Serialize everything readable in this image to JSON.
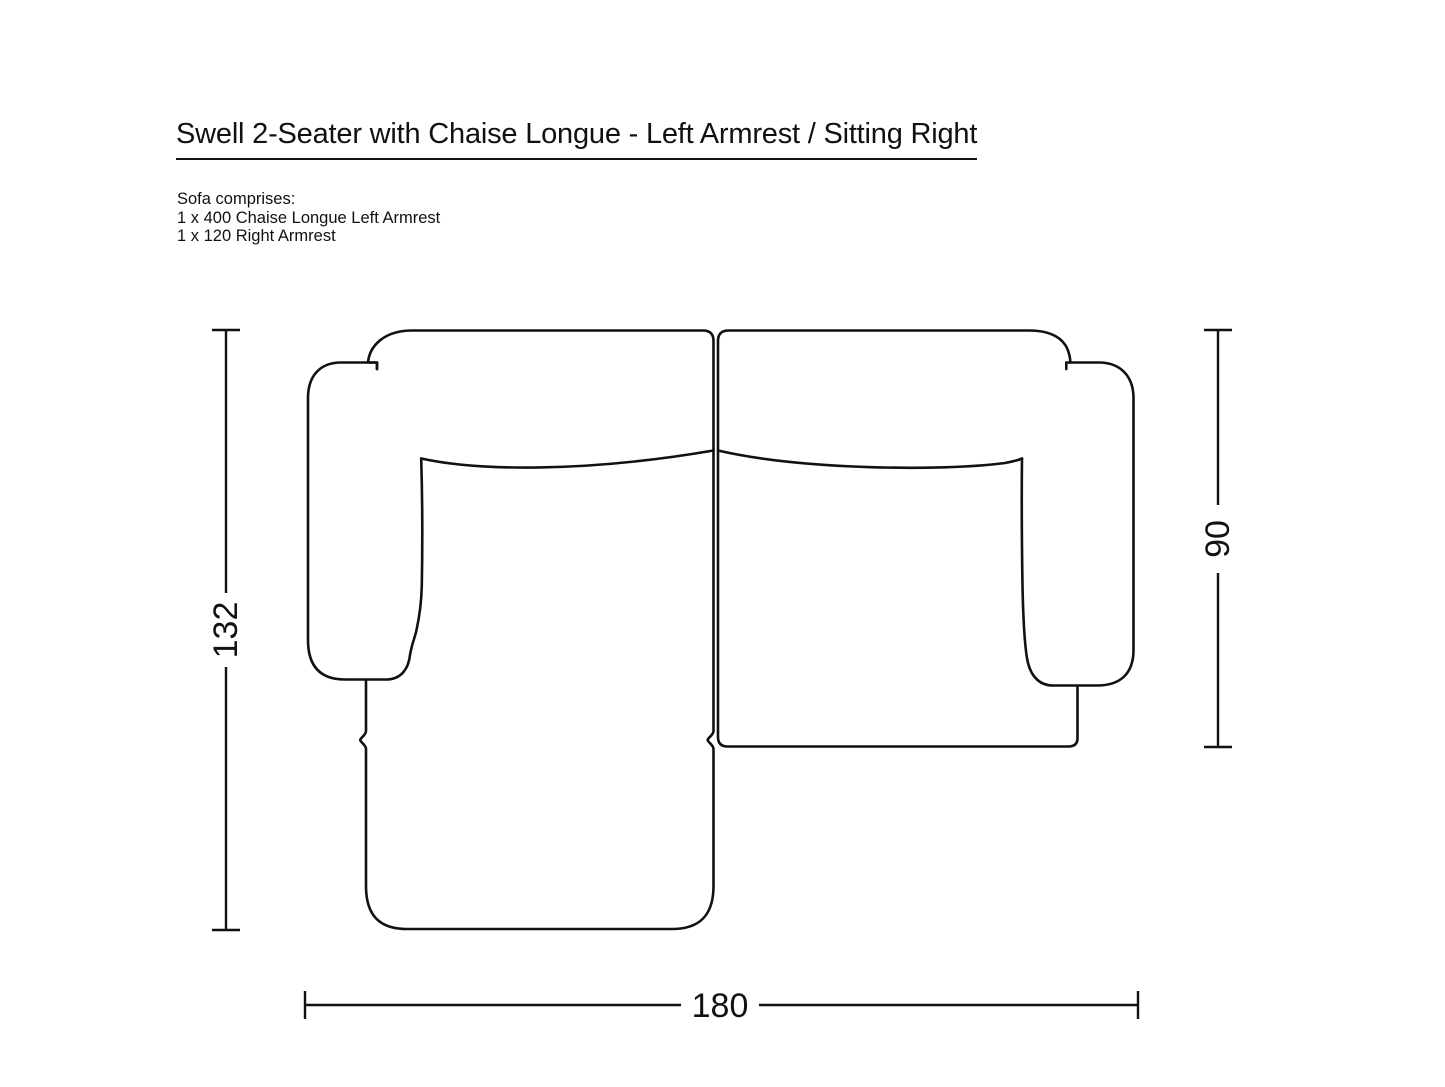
{
  "page": {
    "background_color": "#ffffff",
    "line_color": "#111111"
  },
  "header": {
    "title": "Swell 2-Seater with Chaise Longue - Left Armrest / Sitting Right"
  },
  "composition": {
    "intro": "Sofa comprises:",
    "items": [
      "1 x 400 Chaise Longue Left Armrest",
      "1 x 120 Right Armrest"
    ]
  },
  "diagram": {
    "view": "top view technical line drawing of sofa",
    "modules": [
      "400 Chaise Longue Left Armrest",
      "120 Right Armrest"
    ],
    "dimensions": {
      "overall_depth_cm": "132",
      "seat_depth_cm": "90",
      "overall_width_cm": "180"
    }
  }
}
